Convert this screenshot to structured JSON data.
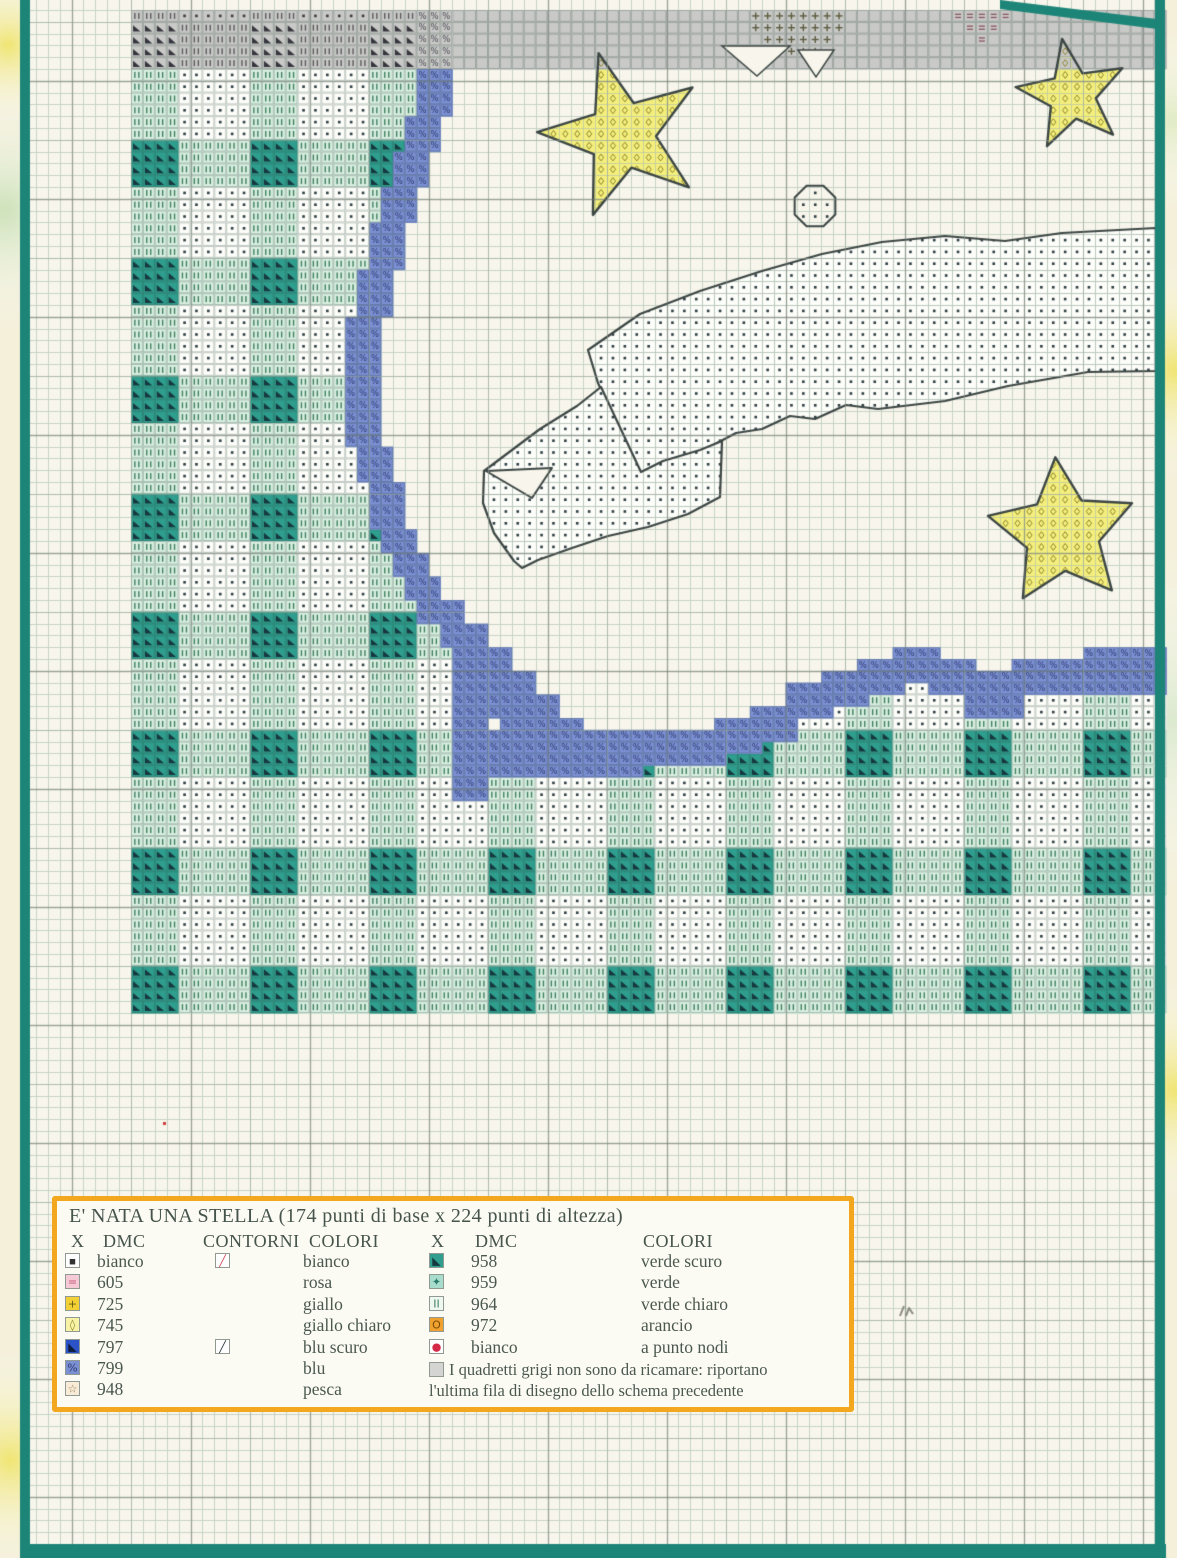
{
  "page": {
    "colors": {
      "margin": "#f4f0da",
      "paper": "#f8f6ec",
      "frame": "#1d8578",
      "grid_thin": "#c6d2c6",
      "grid_mid": "#9aa69a",
      "grid_bold": "#6f796f",
      "gray_bg": "#c9c9c7",
      "teal_cell": "#2f9e8e",
      "teal_tri": "#16383e",
      "pale_cell": "#d9efe1",
      "pale_sym": "#3f7e5e",
      "white_cell": "#fdfdf9",
      "dot": "#2c3c42",
      "blue_cell": "#7b8fd3",
      "blue_sym": "#2e3c6e",
      "yellow": "#f4ef7d",
      "diamond_sym": "#8f852e",
      "outline": "#3c4644",
      "gray_tri": "#35353d",
      "gray_ii": "#5a5a5f",
      "gray_dot": "#3a3a3f",
      "gray_pct": "#4a4a55",
      "plus_sym": "#5c5c40",
      "eq_sym": "#8a5560",
      "red_dot": "#d04040",
      "pencil": "#8a8a80"
    },
    "blobs": [
      {
        "x": 8,
        "y": 45,
        "r": 80,
        "c": "#f0e678"
      },
      {
        "x": 4,
        "y": 210,
        "r": 120,
        "c": "#cfe3bc"
      },
      {
        "x": 10,
        "y": 1460,
        "r": 110,
        "c": "#f0e678"
      },
      {
        "x": 1174,
        "y": 120,
        "r": 90,
        "c": "#e2ecc6"
      },
      {
        "x": 1175,
        "y": 370,
        "r": 110,
        "c": "#f0e678"
      },
      {
        "x": 1173,
        "y": 720,
        "r": 170,
        "c": "#dcead0"
      },
      {
        "x": 1175,
        "y": 1090,
        "r": 110,
        "c": "#f0e678"
      }
    ]
  },
  "pattern": {
    "grid": {
      "x0": 131,
      "y0": 10,
      "cw": 11.9,
      "ch": 11.8,
      "cols": 86,
      "rows": 85
    },
    "gray_band": {
      "row_start": 0,
      "row_end": 4,
      "gingham_cols": 24
    },
    "plus_cells": [
      [
        0,
        52,
        59
      ],
      [
        1,
        52,
        59
      ],
      [
        2,
        53,
        58
      ],
      [
        3,
        55,
        57
      ],
      [
        4,
        57,
        57
      ]
    ],
    "eq_cells": [
      [
        0,
        69,
        73
      ],
      [
        1,
        70,
        72
      ],
      [
        2,
        71,
        71
      ]
    ],
    "notches": [
      [
        [
          722,
          46
        ],
        [
          757,
          76
        ],
        [
          790,
          46
        ]
      ],
      [
        [
          798,
          50
        ],
        [
          816,
          77
        ],
        [
          834,
          50
        ]
      ]
    ],
    "blue_descent": [
      [
        0,
        8,
        24,
        26
      ],
      [
        9,
        11,
        23,
        25
      ],
      [
        12,
        14,
        22,
        24
      ],
      [
        15,
        17,
        21,
        23
      ],
      [
        18,
        21,
        20,
        22
      ],
      [
        22,
        25,
        19,
        21
      ],
      [
        26,
        36,
        18,
        20
      ],
      [
        37,
        39,
        19,
        21
      ],
      [
        40,
        43,
        20,
        22
      ],
      [
        44,
        45,
        21,
        23
      ],
      [
        46,
        47,
        22,
        24
      ],
      [
        48,
        49,
        23,
        25
      ],
      [
        50,
        51,
        24,
        27
      ],
      [
        52,
        53,
        26,
        29
      ],
      [
        54,
        56,
        27,
        31
      ],
      [
        57,
        66,
        27,
        29
      ],
      [
        56,
        58,
        29,
        33
      ],
      [
        58,
        59,
        30,
        35
      ],
      [
        60,
        60,
        31,
        37
      ],
      [
        61,
        63,
        28,
        49
      ],
      [
        64,
        64,
        30,
        42
      ]
    ],
    "blue_wavy": [
      [
        60,
        62,
        49,
        52
      ],
      [
        59,
        61,
        52,
        55
      ],
      [
        57,
        59,
        55,
        58
      ],
      [
        56,
        58,
        58,
        61
      ],
      [
        55,
        57,
        61,
        64
      ],
      [
        54,
        56,
        64,
        67
      ],
      [
        55,
        57,
        67,
        70
      ],
      [
        56,
        59,
        70,
        74
      ],
      [
        55,
        57,
        74,
        77
      ],
      [
        55,
        57,
        77,
        80
      ],
      [
        54,
        57,
        80,
        86
      ]
    ],
    "gingham": {
      "green_col_mod": 4,
      "period": 10,
      "row_start": 5,
      "row_white_len": 6,
      "bottom_row_start": 64,
      "bottom_row_end": 84
    },
    "clouds": [
      [
        [
          588,
          350
        ],
        [
          640,
          314
        ],
        [
          700,
          291
        ],
        [
          762,
          271
        ],
        [
          822,
          254
        ],
        [
          882,
          242
        ],
        [
          945,
          236
        ],
        [
          1005,
          241
        ],
        [
          1062,
          233
        ],
        [
          1156,
          228
        ],
        [
          1156,
          371
        ],
        [
          1088,
          372
        ],
        [
          1008,
          386
        ],
        [
          945,
          401
        ],
        [
          878,
          409
        ],
        [
          846,
          405
        ],
        [
          815,
          419
        ],
        [
          790,
          416
        ],
        [
          762,
          429
        ],
        [
          736,
          433
        ],
        [
          700,
          452
        ],
        [
          662,
          466
        ],
        [
          641,
          478
        ],
        [
          598,
          383
        ]
      ],
      [
        [
          484,
          471
        ],
        [
          540,
          429
        ],
        [
          577,
          406
        ],
        [
          601,
          387
        ],
        [
          641,
          472
        ],
        [
          663,
          461
        ],
        [
          700,
          450
        ],
        [
          722,
          441
        ],
        [
          720,
          497
        ],
        [
          688,
          514
        ],
        [
          648,
          527
        ],
        [
          608,
          536
        ],
        [
          572,
          548
        ],
        [
          538,
          560
        ],
        [
          522,
          568
        ],
        [
          514,
          561
        ],
        [
          494,
          533
        ],
        [
          483,
          503
        ]
      ]
    ],
    "cloud_notch": [
      [
        486,
        471
      ],
      [
        552,
        468
      ],
      [
        532,
        498
      ]
    ],
    "stars": [
      {
        "cx": 622,
        "cy": 135,
        "ro": 85,
        "ri": 34,
        "n": 5,
        "rot": -106,
        "grayAbove": 69
      },
      {
        "cx": 1072,
        "cy": 95,
        "ro": 57,
        "ri": 24,
        "n": 5,
        "rot": -100,
        "grayAbove": 69
      },
      {
        "cx": 1062,
        "cy": 533,
        "ro": 76,
        "ri": 38,
        "n": 5,
        "rot": -95
      }
    ],
    "octagon": {
      "cx": 815,
      "cy": 206,
      "r": 22
    },
    "frame": {
      "left": [
        20,
        0,
        10,
        1558
      ],
      "right": [
        1155,
        0,
        10,
        1558
      ],
      "bottom": [
        20,
        1544,
        1146,
        14
      ],
      "top_right": [
        [
          1000,
          0
        ],
        [
          1165,
          20
        ],
        [
          1165,
          30
        ],
        [
          1000,
          9
        ]
      ]
    },
    "paper_rect": [
      30,
      0,
      1125,
      1544
    ],
    "artifacts": {
      "red_dot": [
        163,
        1122
      ],
      "pencil_mark": [
        900,
        1306
      ]
    }
  },
  "legend": {
    "title": "E' NATA UNA STELLA (174 punti di base x 224 punti di altezza)",
    "headers_left": [
      "X",
      "DMC",
      "CONTORNI",
      "COLORI"
    ],
    "headers_right": [
      "X",
      "DMC",
      "COLORI"
    ],
    "rows_left": [
      {
        "sym": {
          "t": "dot",
          "bg": "#ffffff",
          "fg": "#333333"
        },
        "dmc": "bianco",
        "cont": {
          "t": "slash",
          "fg": "#d2485a"
        },
        "color": "bianco"
      },
      {
        "sym": {
          "t": "eq",
          "bg": "#f6c9d6",
          "fg": "#c05a72"
        },
        "dmc": "605",
        "color": "rosa"
      },
      {
        "sym": {
          "t": "plus",
          "bg": "#f3d135",
          "fg": "#6a5a10"
        },
        "dmc": "725",
        "color": "giallo"
      },
      {
        "sym": {
          "t": "diamond",
          "bg": "#f8f3a4",
          "fg": "#8f852e"
        },
        "dmc": "745",
        "color": "giallo chiaro"
      },
      {
        "sym": {
          "t": "tri",
          "bg": "#2c52c8",
          "fg": "#0e1c3e"
        },
        "dmc": "797",
        "cont": {
          "t": "slash",
          "fg": "#2a3438"
        },
        "color": "blu scuro"
      },
      {
        "sym": {
          "t": "pct",
          "bg": "#7b8fd3",
          "fg": "#2e3c6e"
        },
        "dmc": "799",
        "color": "blu"
      },
      {
        "sym": {
          "t": "star",
          "bg": "#f8ecd9",
          "fg": "#9a7a4a"
        },
        "dmc": "948",
        "color": "pesca"
      }
    ],
    "rows_right": [
      {
        "sym": {
          "t": "tri",
          "bg": "#2f9e8e",
          "fg": "#16383e"
        },
        "dmc": "958",
        "color": "verde scuro"
      },
      {
        "sym": {
          "t": "sparkle",
          "bg": "#a8dccc",
          "fg": "#2a7a6a"
        },
        "dmc": "959",
        "color": "verde"
      },
      {
        "sym": {
          "t": "ii",
          "bg": "#eef8f0",
          "fg": "#3f7e5e"
        },
        "dmc": "964",
        "color": "verde chiaro"
      },
      {
        "sym": {
          "t": "o",
          "bg": "#f0a12e",
          "fg": "#7a4a08"
        },
        "dmc": "972",
        "color": "arancio"
      },
      {
        "sym": {
          "t": "knot",
          "bg": "#ffffff",
          "fg": "#d42a48"
        },
        "dmc": "bianco",
        "color": "a punto nodi"
      }
    ],
    "note": {
      "sym": {
        "t": "gray",
        "bg": "#d4d4d2",
        "fg": "#777777"
      },
      "line1": "I quadretti grigi non sono da ricamare: riportano",
      "line2": "l'ultima fila di disegno dello schema precedente"
    }
  }
}
